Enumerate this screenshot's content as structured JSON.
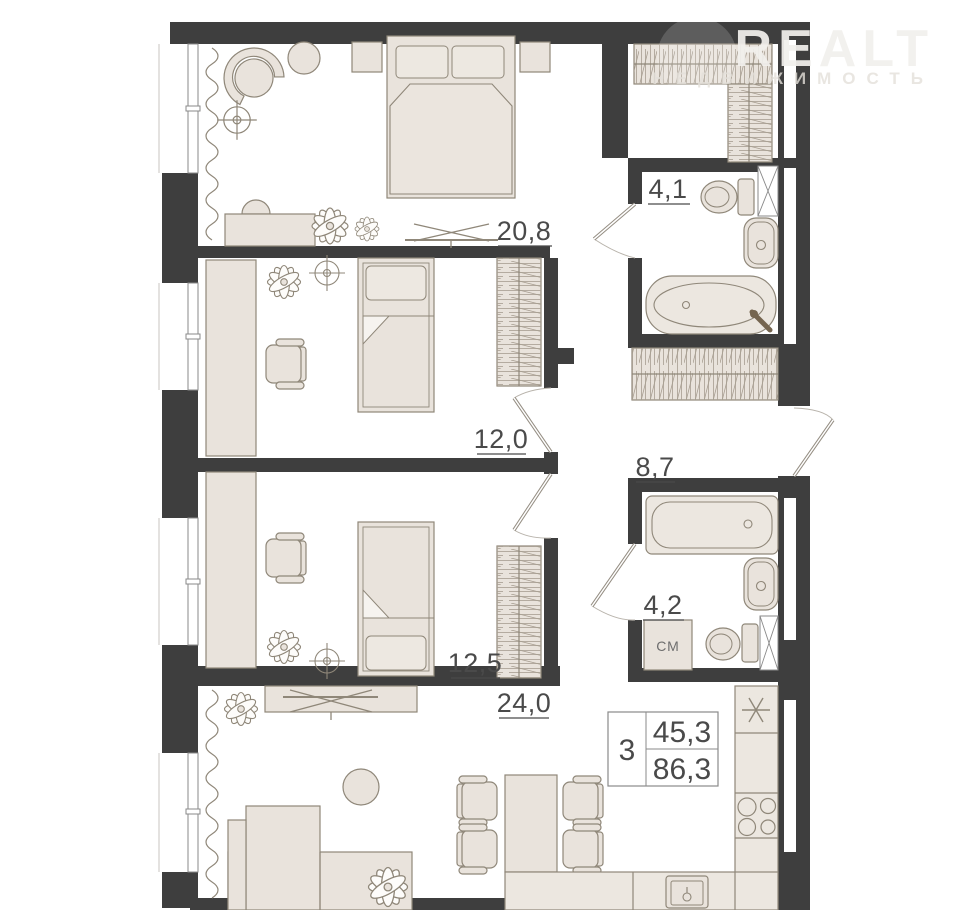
{
  "watermark": {
    "brand": "REALT",
    "tagline": "НЕДВИЖИМОСТЬ"
  },
  "areas": {
    "bedroom": "20,8",
    "bathroom_main": "4,1",
    "kids_room_1": "12,0",
    "hallway": "8,7",
    "kids_room_2": "12,5",
    "bathroom_guest": "4,2",
    "living_kitchen": "24,0"
  },
  "summary": {
    "rooms": "3",
    "living_area": "45,3",
    "total_area": "86,3"
  },
  "appliances": {
    "washing_machine": "СМ"
  },
  "colors": {
    "wall": "#3e3e3e",
    "furniture_fill": "#e9e3dc",
    "furniture_stroke": "#8f8779",
    "label": "#4a4a4a"
  }
}
